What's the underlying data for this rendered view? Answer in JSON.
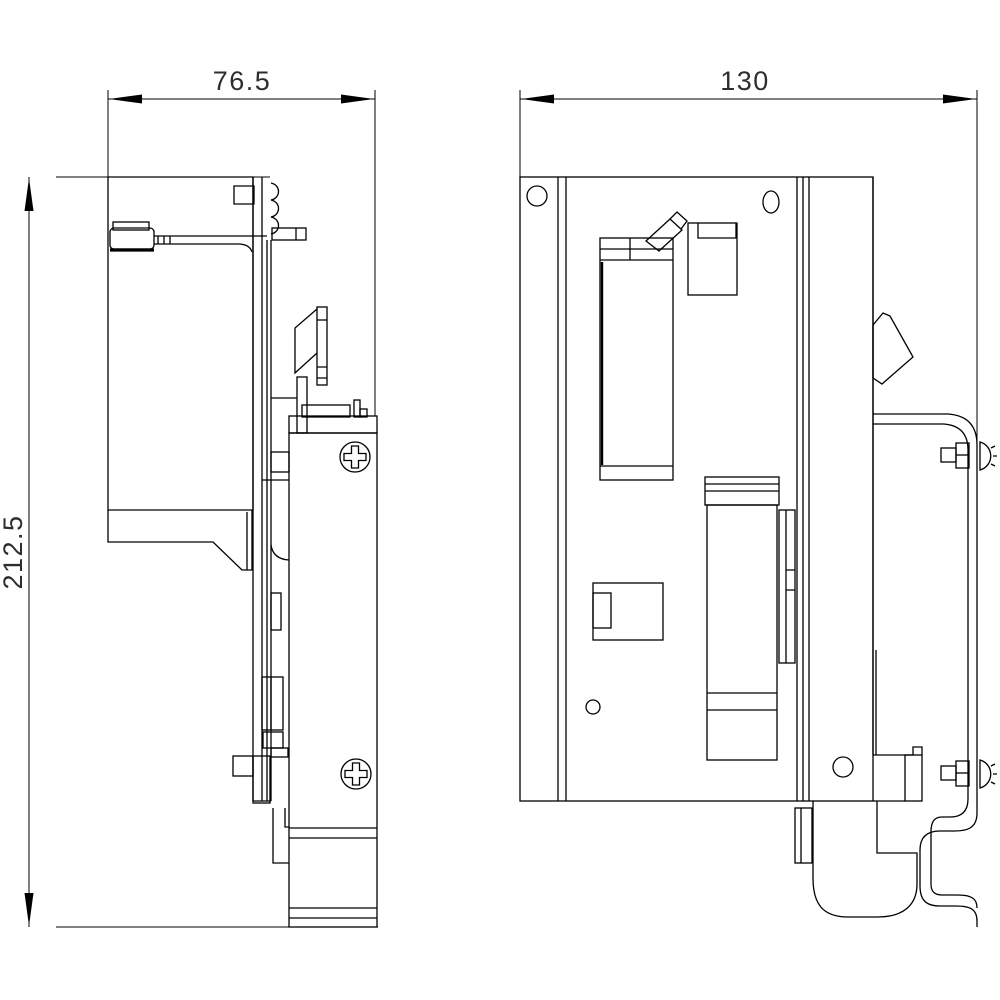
{
  "drawing": {
    "kind": "technical-dimension-drawing",
    "views": {
      "side_view": {
        "width_label": "76.5",
        "height_label": "212.5"
      },
      "front_view": {
        "width_label": "130"
      }
    },
    "dimensions": {
      "side_view_width": "76.5",
      "front_view_width": "130",
      "overall_height": "212.5"
    },
    "colors": {
      "line": "#000000",
      "background": "#ffffff",
      "text": "#2e2e2e"
    }
  }
}
